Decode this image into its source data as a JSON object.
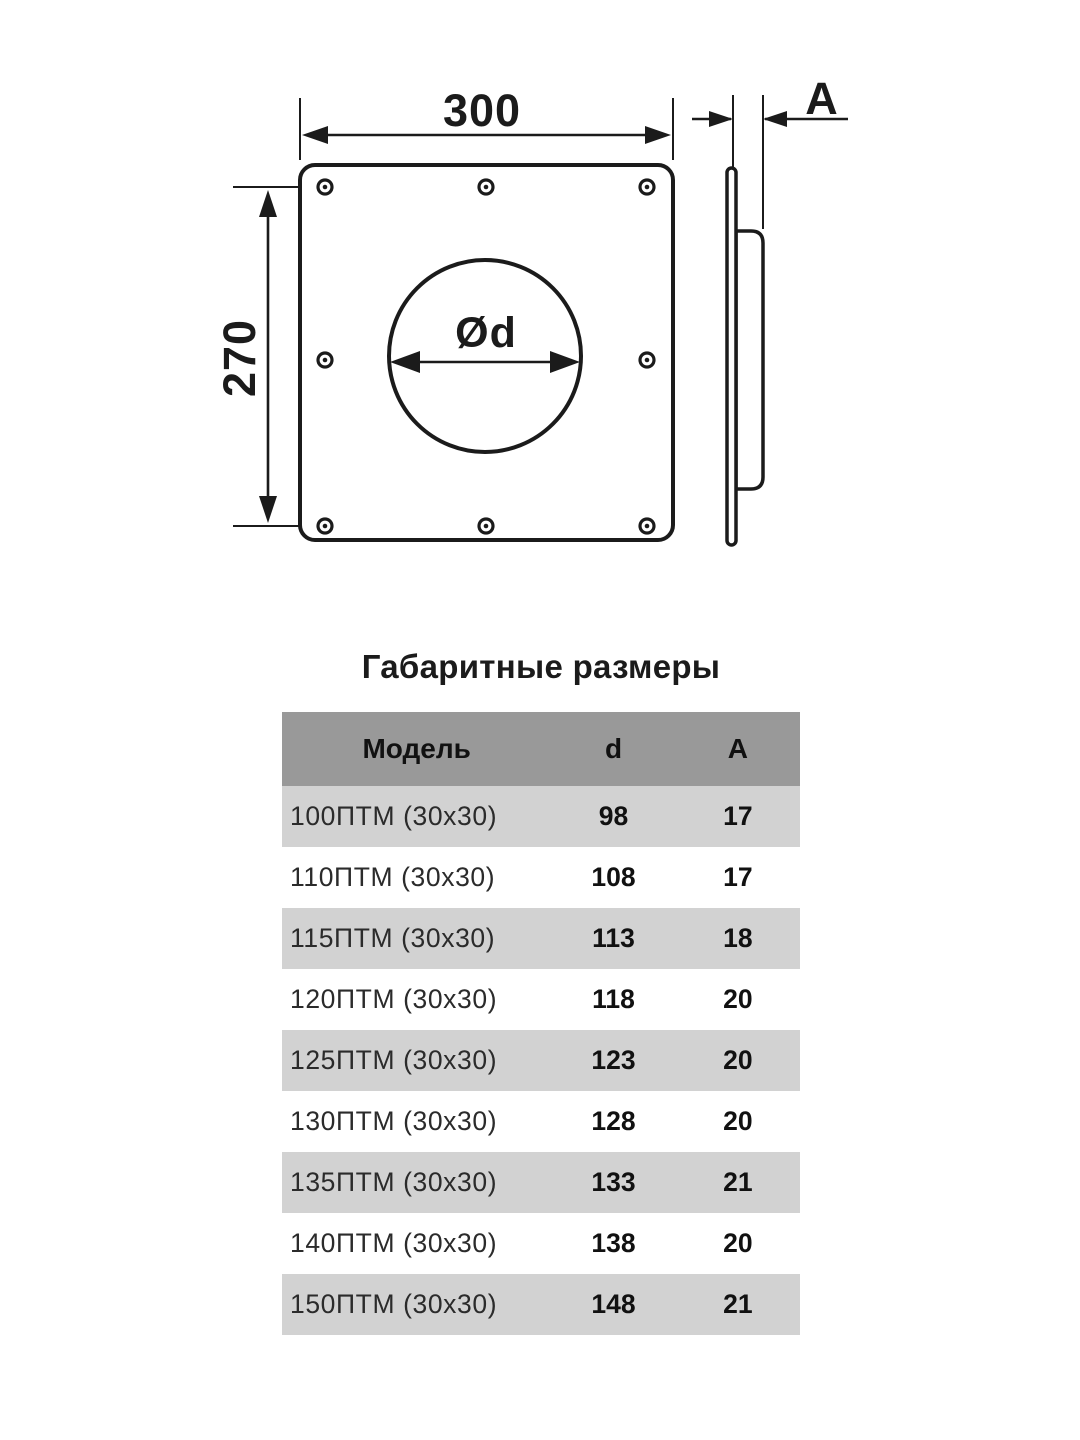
{
  "diagram": {
    "front": {
      "width": "300",
      "height": "270",
      "diameter": "Ød"
    },
    "side": {
      "depth": "A"
    }
  },
  "table": {
    "title": "Габаритные размеры",
    "columns": [
      "Модель",
      "d",
      "A"
    ],
    "rows": [
      {
        "model": "100ПТМ (30х30)",
        "d": "98",
        "a": "17"
      },
      {
        "model": "110ПТМ (30х30)",
        "d": "108",
        "a": "17"
      },
      {
        "model": "115ПТМ (30х30)",
        "d": "113",
        "a": "18"
      },
      {
        "model": "120ПТМ (30х30)",
        "d": "118",
        "a": "20"
      },
      {
        "model": "125ПТМ (30х30)",
        "d": "123",
        "a": "20"
      },
      {
        "model": "130ПТМ (30х30)",
        "d": "128",
        "a": "20"
      },
      {
        "model": "135ПТМ (30х30)",
        "d": "133",
        "a": "21"
      },
      {
        "model": "140ПТМ (30х30)",
        "d": "138",
        "a": "20"
      },
      {
        "model": "150ПТМ (30х30)",
        "d": "148",
        "a": "21"
      }
    ]
  },
  "colors": {
    "ink": "#1b1b1b",
    "table_header_bg": "#999999",
    "table_row_alt_bg": "#d2d2d2",
    "model_text": "#2b2b2b"
  }
}
